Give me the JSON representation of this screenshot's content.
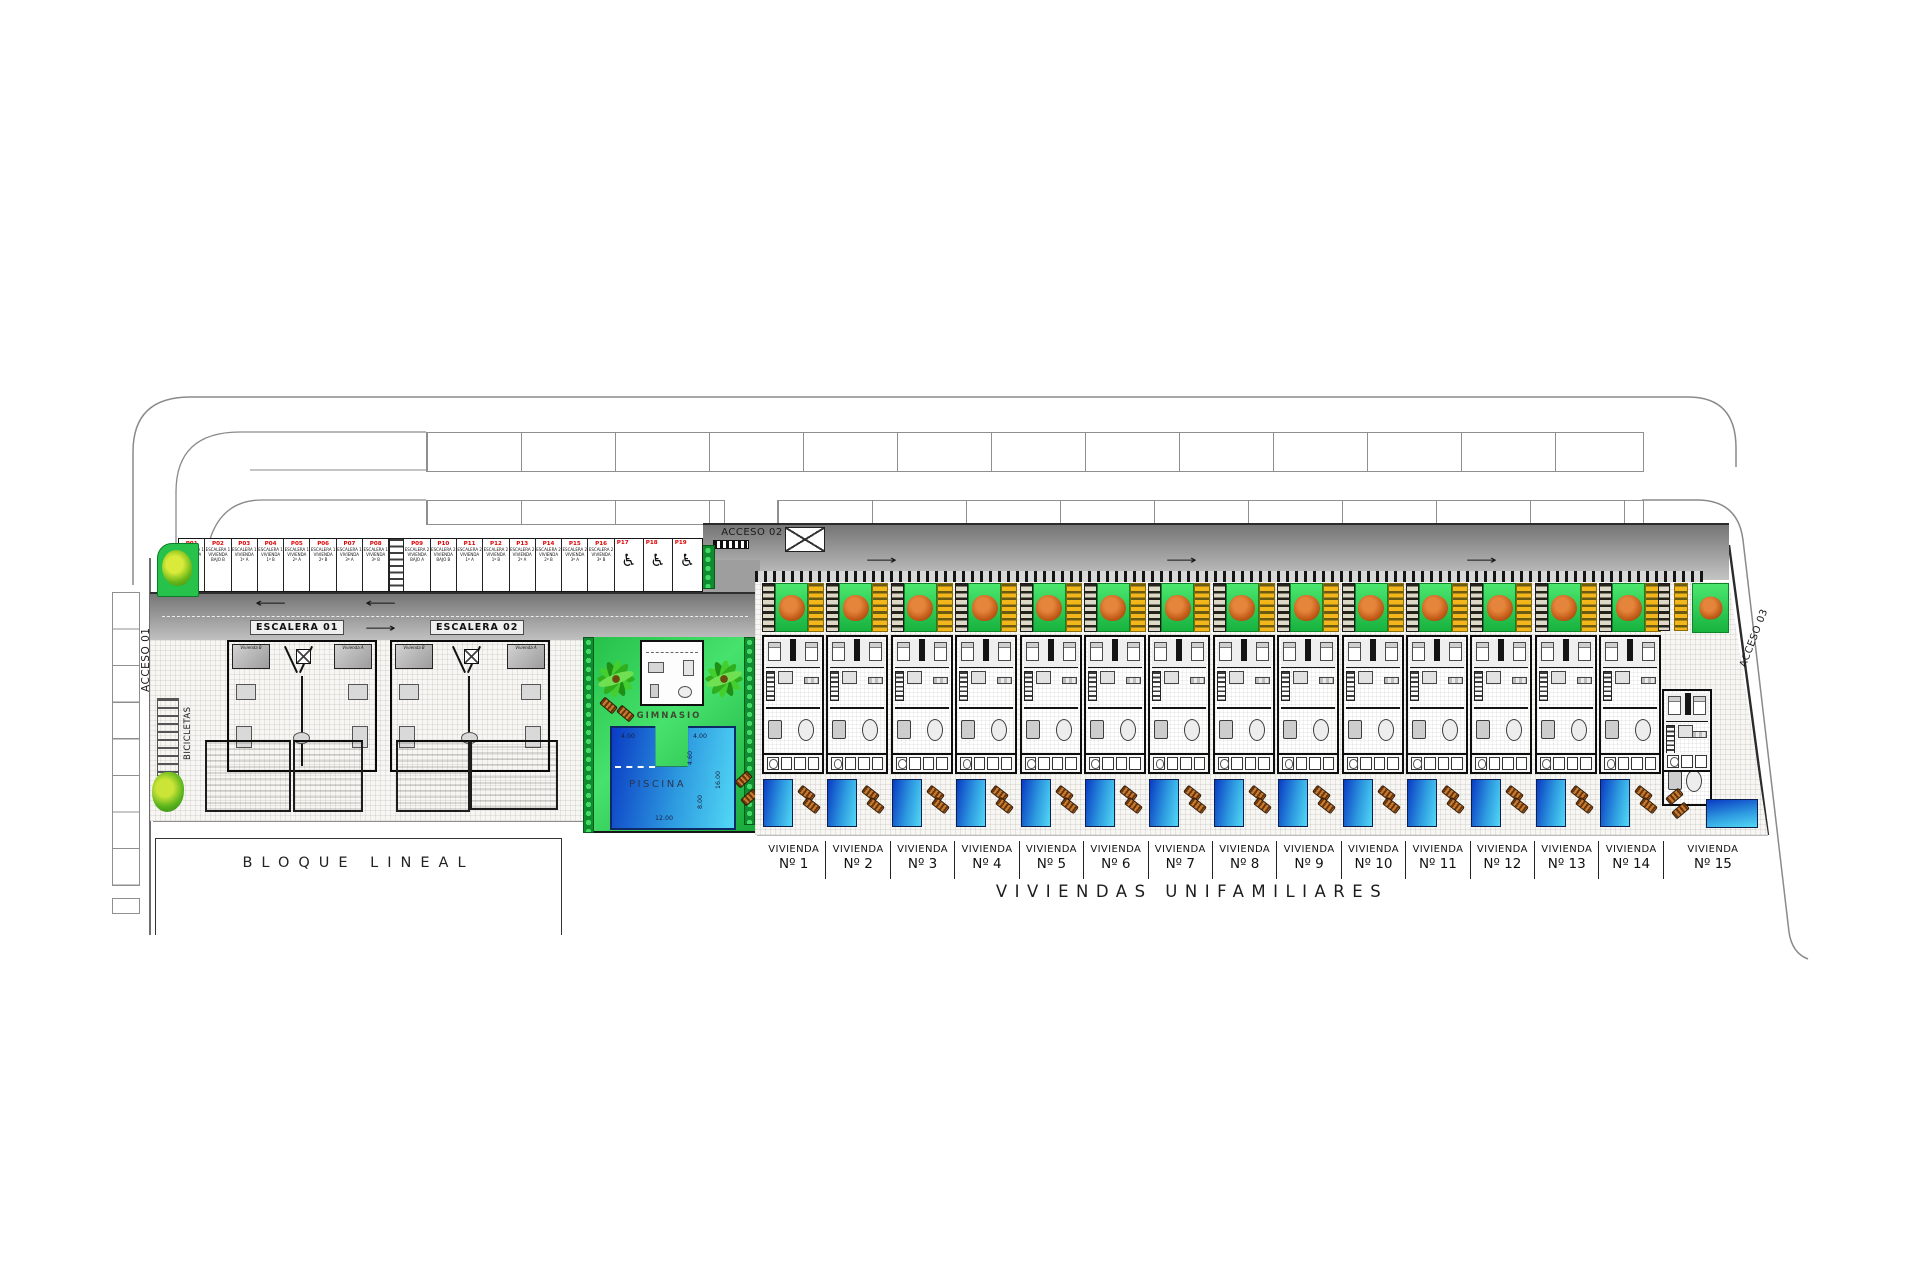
{
  "title": {
    "main": "VIVIENDAS UNIFAMILIARES"
  },
  "accesses": {
    "a1": "ACCESO 01",
    "a2": "ACCESO 02",
    "a3": "ACCESO 03"
  },
  "bloque": {
    "label": "BLOQUE LINEAL",
    "escalera1": "ESCALERA 01",
    "escalera2": "ESCALERA 02",
    "bicicletas": "BICICLETAS",
    "unit_a": "Vivienda A",
    "unit_b": "Vivienda B"
  },
  "amenities": {
    "gym": "GIMNASIO",
    "pool": "PISCINA",
    "pool_dims": {
      "w_left": "4.00",
      "w_right": "4.00",
      "notch_depth": "4.60",
      "len_right": "16.00",
      "mid_depth": "8.00",
      "len_bottom": "12.00"
    }
  },
  "parking": {
    "row_escalera1": [
      {
        "num": "P01",
        "line1": "ESCALERA 1",
        "line2": "VIVIENDA",
        "line3": "BAJO A"
      },
      {
        "num": "P02",
        "line1": "ESCALERA 1",
        "line2": "VIVIENDA",
        "line3": "BAJO B"
      },
      {
        "num": "P03",
        "line1": "ESCALERA 1",
        "line2": "VIVIENDA",
        "line3": "1º A"
      },
      {
        "num": "P04",
        "line1": "ESCALERA 1",
        "line2": "VIVIENDA",
        "line3": "1º B"
      },
      {
        "num": "P05",
        "line1": "ESCALERA 1",
        "line2": "VIVIENDA",
        "line3": "2º A"
      },
      {
        "num": "P06",
        "line1": "ESCALERA 1",
        "line2": "VIVIENDA",
        "line3": "2º B"
      },
      {
        "num": "P07",
        "line1": "ESCALERA 1",
        "line2": "VIVIENDA",
        "line3": "3º A"
      },
      {
        "num": "P08",
        "line1": "ESCALERA 1",
        "line2": "VIVIENDA",
        "line3": "3º B"
      }
    ],
    "row_escalera2": [
      {
        "num": "P09",
        "line1": "ESCALERA 2",
        "line2": "VIVIENDA",
        "line3": "BAJO A"
      },
      {
        "num": "P10",
        "line1": "ESCALERA 2",
        "line2": "VIVIENDA",
        "line3": "BAJO B"
      },
      {
        "num": "P11",
        "line1": "ESCALERA 2",
        "line2": "VIVIENDA",
        "line3": "1º A"
      },
      {
        "num": "P12",
        "line1": "ESCALERA 2",
        "line2": "VIVIENDA",
        "line3": "1º B"
      },
      {
        "num": "P13",
        "line1": "ESCALERA 2",
        "line2": "VIVIENDA",
        "line3": "2º A"
      },
      {
        "num": "P14",
        "line1": "ESCALERA 2",
        "line2": "VIVIENDA",
        "line3": "2º B"
      },
      {
        "num": "P15",
        "line1": "ESCALERA 2",
        "line2": "VIVIENDA",
        "line3": "3º A"
      },
      {
        "num": "P16",
        "line1": "ESCALERA 2",
        "line2": "VIVIENDA",
        "line3": "3º B"
      }
    ],
    "handicap": [
      {
        "num": "P17"
      },
      {
        "num": "P18"
      },
      {
        "num": "P19"
      }
    ]
  },
  "villas": {
    "prefix": "VIVIENDA",
    "numbers": [
      {
        "n": "Nº 1"
      },
      {
        "n": "Nº 2"
      },
      {
        "n": "Nº 3"
      },
      {
        "n": "Nº 4"
      },
      {
        "n": "Nº 5"
      },
      {
        "n": "Nº 6"
      },
      {
        "n": "Nº 7"
      },
      {
        "n": "Nº 8"
      },
      {
        "n": "Nº 9"
      },
      {
        "n": "Nº 10"
      },
      {
        "n": "Nº 11"
      },
      {
        "n": "Nº 12"
      },
      {
        "n": "Nº 13"
      },
      {
        "n": "Nº 14"
      },
      {
        "n": "Nº 15"
      }
    ]
  },
  "icons": {
    "wheelchair": "♿",
    "arrow_left": "⟵",
    "arrow_right": "⟶"
  },
  "colors": {
    "road": "#8f8f8f",
    "lawn": "#2ecc56",
    "pergola": "#f3b71c",
    "tree_canopy": "#c05a17",
    "pool_dark": "#0a3bc4",
    "pool_light": "#52d8f5",
    "stall_number_red": "#e00000",
    "hedge": "#0f8c2d",
    "ground": "#f7f6f2"
  }
}
